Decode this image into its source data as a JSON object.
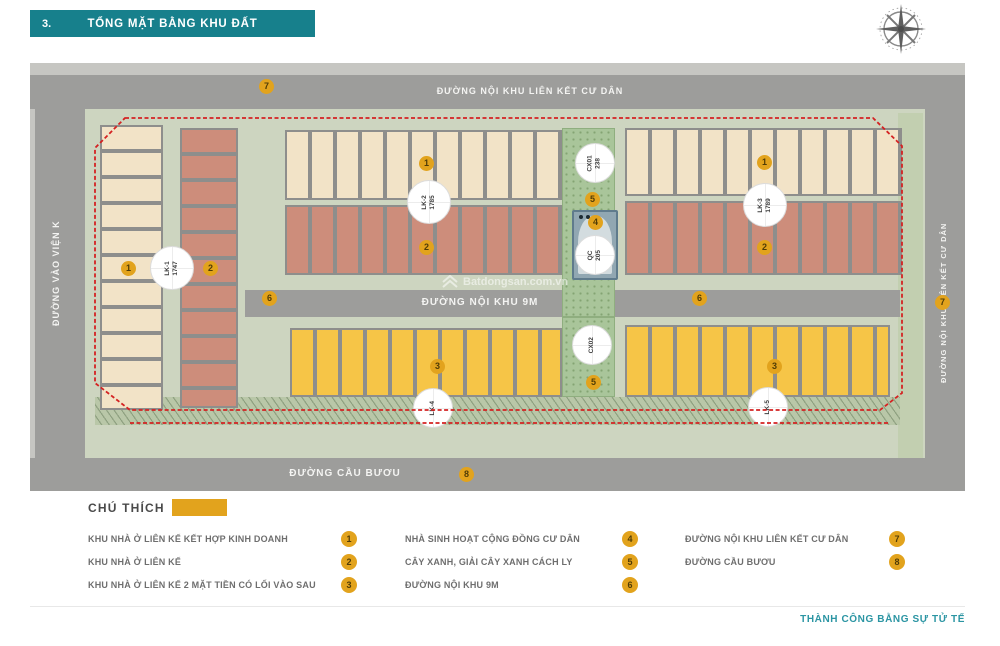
{
  "header": {
    "section_number": "3.",
    "title": "TỔNG MẶT BẰNG KHU ĐẤT"
  },
  "map": {
    "roads": {
      "top": {
        "label": "ĐƯỜNG NỘI KHU LIÊN KẾT CƯ DÂN"
      },
      "right": {
        "label": "ĐƯỜNG NỘI KHU LIÊN KẾT CƯ DÂN"
      },
      "left": {
        "label": "ĐƯỜNG VÀO VIỆN K"
      },
      "inner": {
        "label": "ĐƯỜNG NỘI KHU 9M"
      },
      "bottom": {
        "label": "ĐƯỜNG CẦU BƯƠU"
      }
    },
    "markers": {
      "zone1": "1",
      "zone2": "2",
      "zone3": "3",
      "zone4": "4",
      "zone5": "5",
      "zone6": "6",
      "zone7": "7",
      "zone8": "8"
    },
    "plots": {
      "lk1": {
        "code": "LK-1",
        "area": "1747"
      },
      "lk2": {
        "code": "LK-2",
        "area": "1785"
      },
      "lk3": {
        "code": "LK-3",
        "area": "1789"
      },
      "lk4": {
        "code": "LK-4",
        "area": ""
      },
      "lk5": {
        "code": "LK-5",
        "area": ""
      },
      "cx01": {
        "code": "CX01",
        "area": "238"
      },
      "cx02": {
        "code": "CX02",
        "area": ""
      },
      "qc": {
        "code": "QC",
        "area": "205"
      }
    },
    "watermark": "Batdongsan.com.vn"
  },
  "legend": {
    "title": "CHÚ THÍCH",
    "items": [
      {
        "label": "KHU NHÀ Ở LIÊN KẾ KẾT HỢP KINH DOANH",
        "badge": "1"
      },
      {
        "label": "KHU NHÀ Ở LIÊN KẾ",
        "badge": "2"
      },
      {
        "label": "KHU NHÀ Ở LIÊN KẾ 2 MẶT TIỀN CÓ LỐI VÀO SAU",
        "badge": "3"
      },
      {
        "label": "NHÀ SINH HOẠT CỘNG ĐỒNG CƯ DÂN",
        "badge": "4"
      },
      {
        "label": "CÂY XANH, GIẢI CÂY XANH CÁCH LY",
        "badge": "5"
      },
      {
        "label": "ĐƯỜNG NỘI KHU 9M",
        "badge": "6"
      },
      {
        "label": "ĐƯỜNG NỘI KHU LIÊN KẾT CƯ DÂN",
        "badge": "7"
      },
      {
        "label": "ĐƯỜNG CẦU BƯƠU",
        "badge": "8"
      }
    ]
  },
  "footer": {
    "slogan": "THÀNH CÔNG BẰNG SỰ TỬ TẾ"
  }
}
